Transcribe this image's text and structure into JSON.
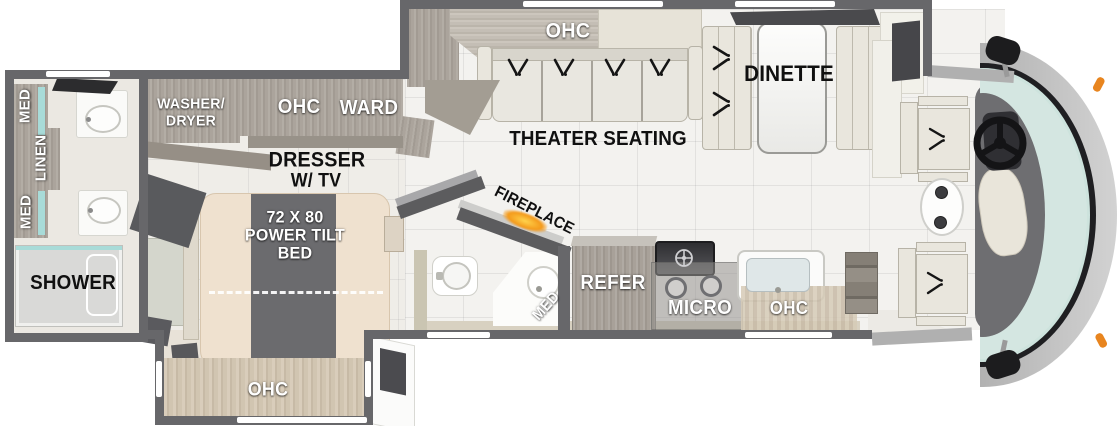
{
  "diagram_type": "rv-motorhome-floorplan",
  "labels": {
    "rear_bath": {
      "med_upper": "MED",
      "linen": "LINEN",
      "med_lower": "MED",
      "shower": "SHOWER"
    },
    "bedroom": {
      "washer_dryer": [
        "WASHER/",
        "DRYER"
      ],
      "ohc": "OHC",
      "ward": "WARD",
      "dresser": [
        "DRESSER",
        "W/ TV"
      ],
      "bed": [
        "72 X 80",
        "POWER TILT",
        "BED"
      ],
      "slide_ohc": "OHC"
    },
    "half_bath": {
      "med": "MED"
    },
    "living": {
      "fireplace": "FIREPLACE",
      "ohc": "OHC",
      "theater": "THEATER SEATING",
      "dinette": "DINETTE"
    },
    "kitchen": {
      "refer": "REFER",
      "micro": "MICRO",
      "ohc": "OHC"
    }
  },
  "colors": {
    "wall": "#67676a",
    "floor_tile": "#f3f2ef",
    "wood_gray": "#a8a199",
    "wood_tan": "#d1c5b1",
    "accent_teal": "#a8dbd8",
    "bed_cream": "#efe1cf",
    "bed_runner": "#6b6b6e",
    "windshield": "#cde3dd",
    "flame_orange": "#f49a1b",
    "marker_orange": "#e8851f",
    "label_white": "#ffffff",
    "label_black": "#101010",
    "seat_light": "#e9e6dd"
  },
  "icons": {
    "sink-icon": "oval-basin",
    "toilet-icon": "bowl-with-tank",
    "shower-icon": "pan-outline",
    "recline-indicator-icon": "double-tick-chevron",
    "stove-burner-icon": "ring",
    "microwave-fan-icon": "crossed-circle",
    "steering-wheel-icon": "ring-with-spokes",
    "mirror-icon": "rounded-paddle",
    "window-marker": "white-bar",
    "flame-glow-icon": "orange-radial",
    "cupholder-icon": "dark-circle"
  }
}
